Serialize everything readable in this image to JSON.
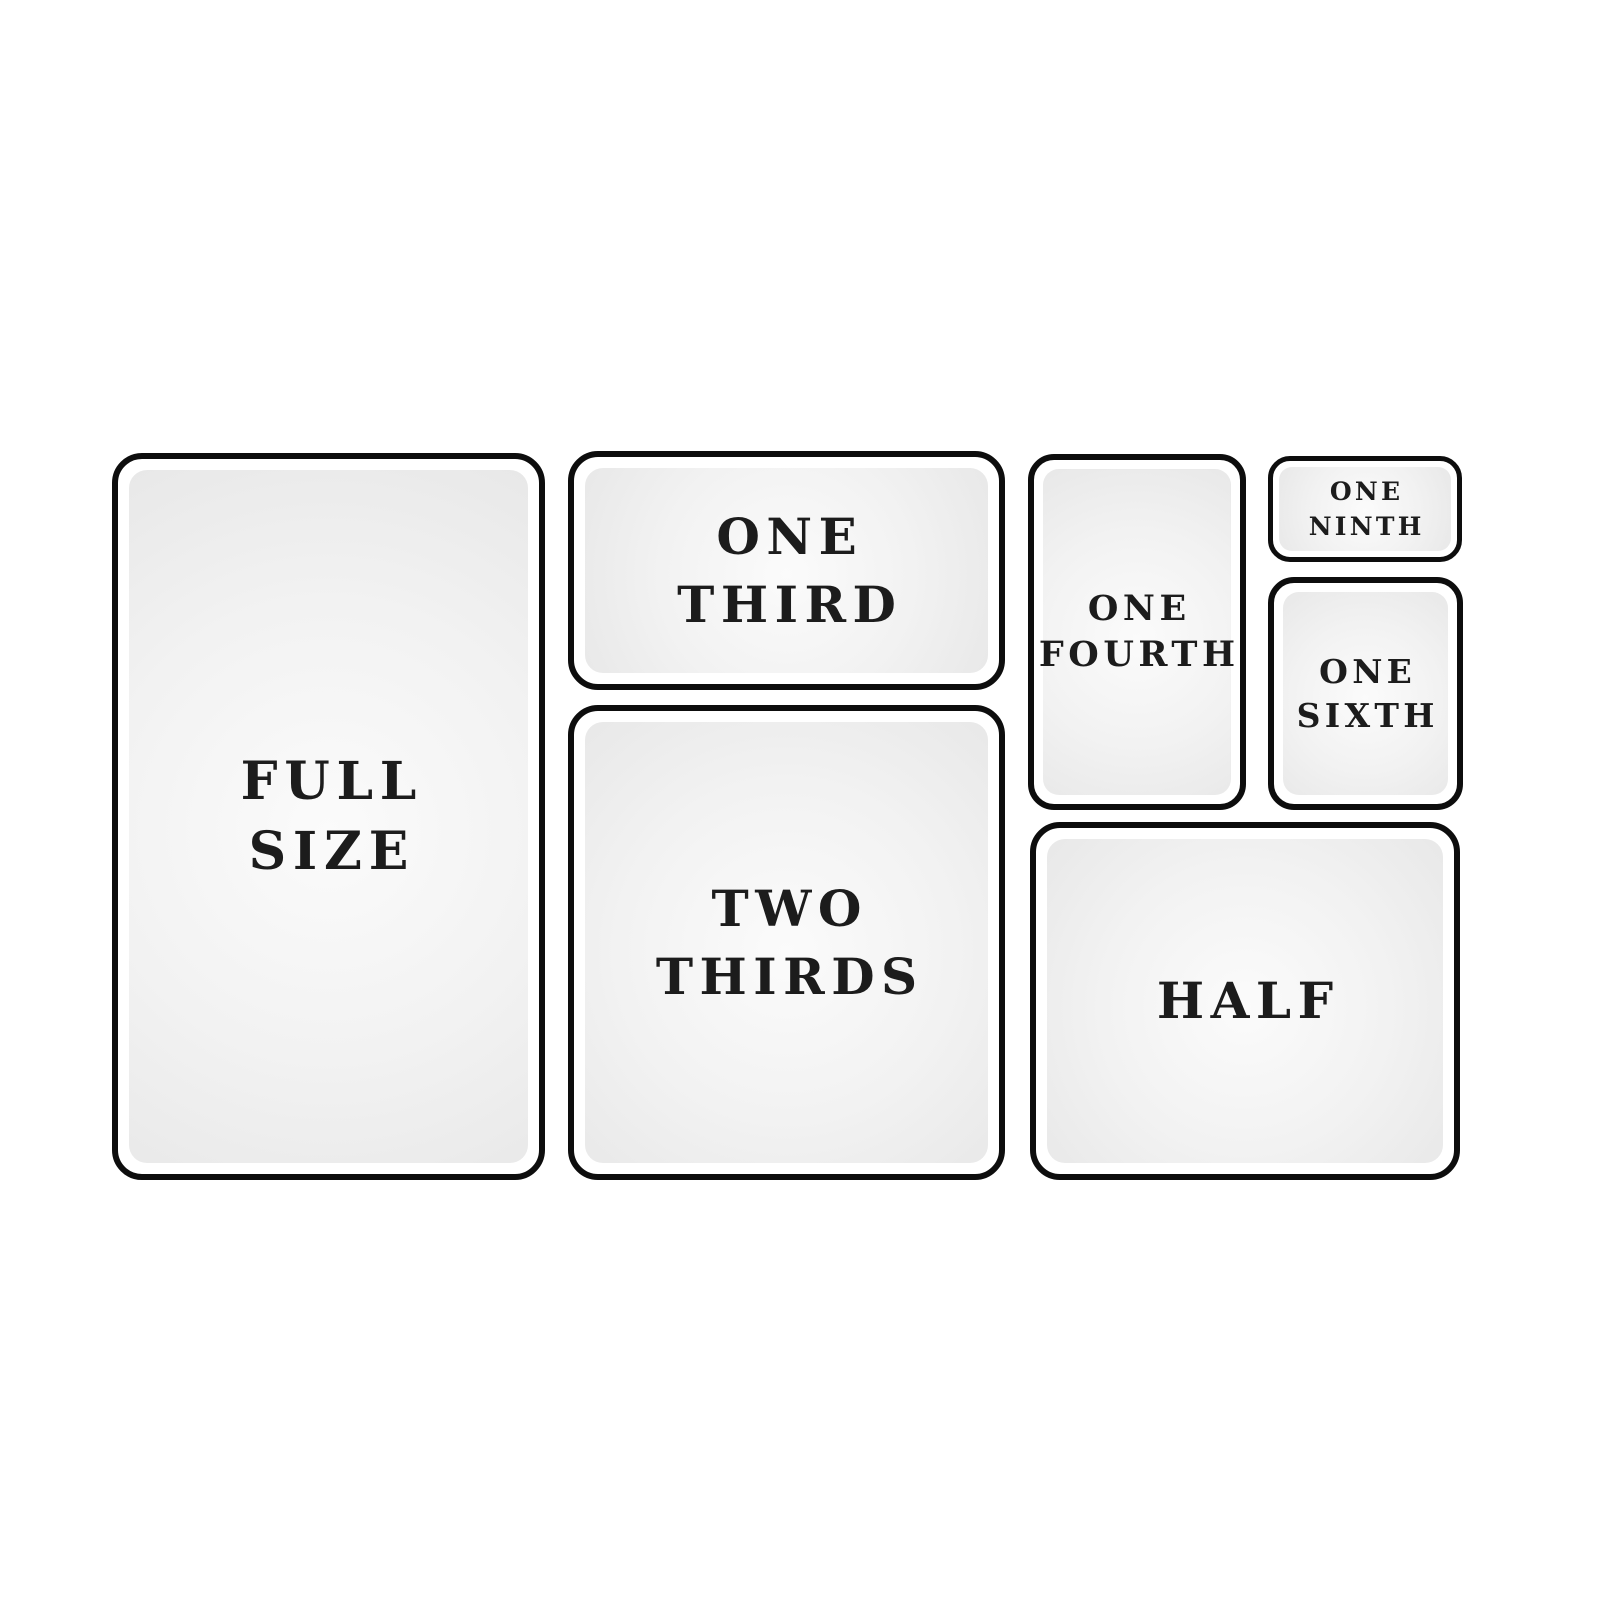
{
  "colors": {
    "background": "#ffffff",
    "pan_border": "#0d0d0d",
    "pan_face_edge": "#e8e8e8",
    "pan_face_mid": "#f2f2f2",
    "pan_face_center": "#fbfbfb",
    "label_text": "#1c1c1c"
  },
  "pans": {
    "full_size": {
      "line1": "FULL",
      "line2": "SIZE"
    },
    "one_third": {
      "line1": "ONE",
      "line2": "THIRD"
    },
    "two_thirds": {
      "line1": "TWO",
      "line2": "THIRDS"
    },
    "one_fourth": {
      "line1": "ONE",
      "line2": "FOURTH"
    },
    "one_ninth": {
      "line1": "ONE",
      "line2": "NINTH"
    },
    "one_sixth": {
      "line1": "ONE",
      "line2": "SIXTH"
    },
    "half": {
      "line1": "HALF"
    }
  }
}
